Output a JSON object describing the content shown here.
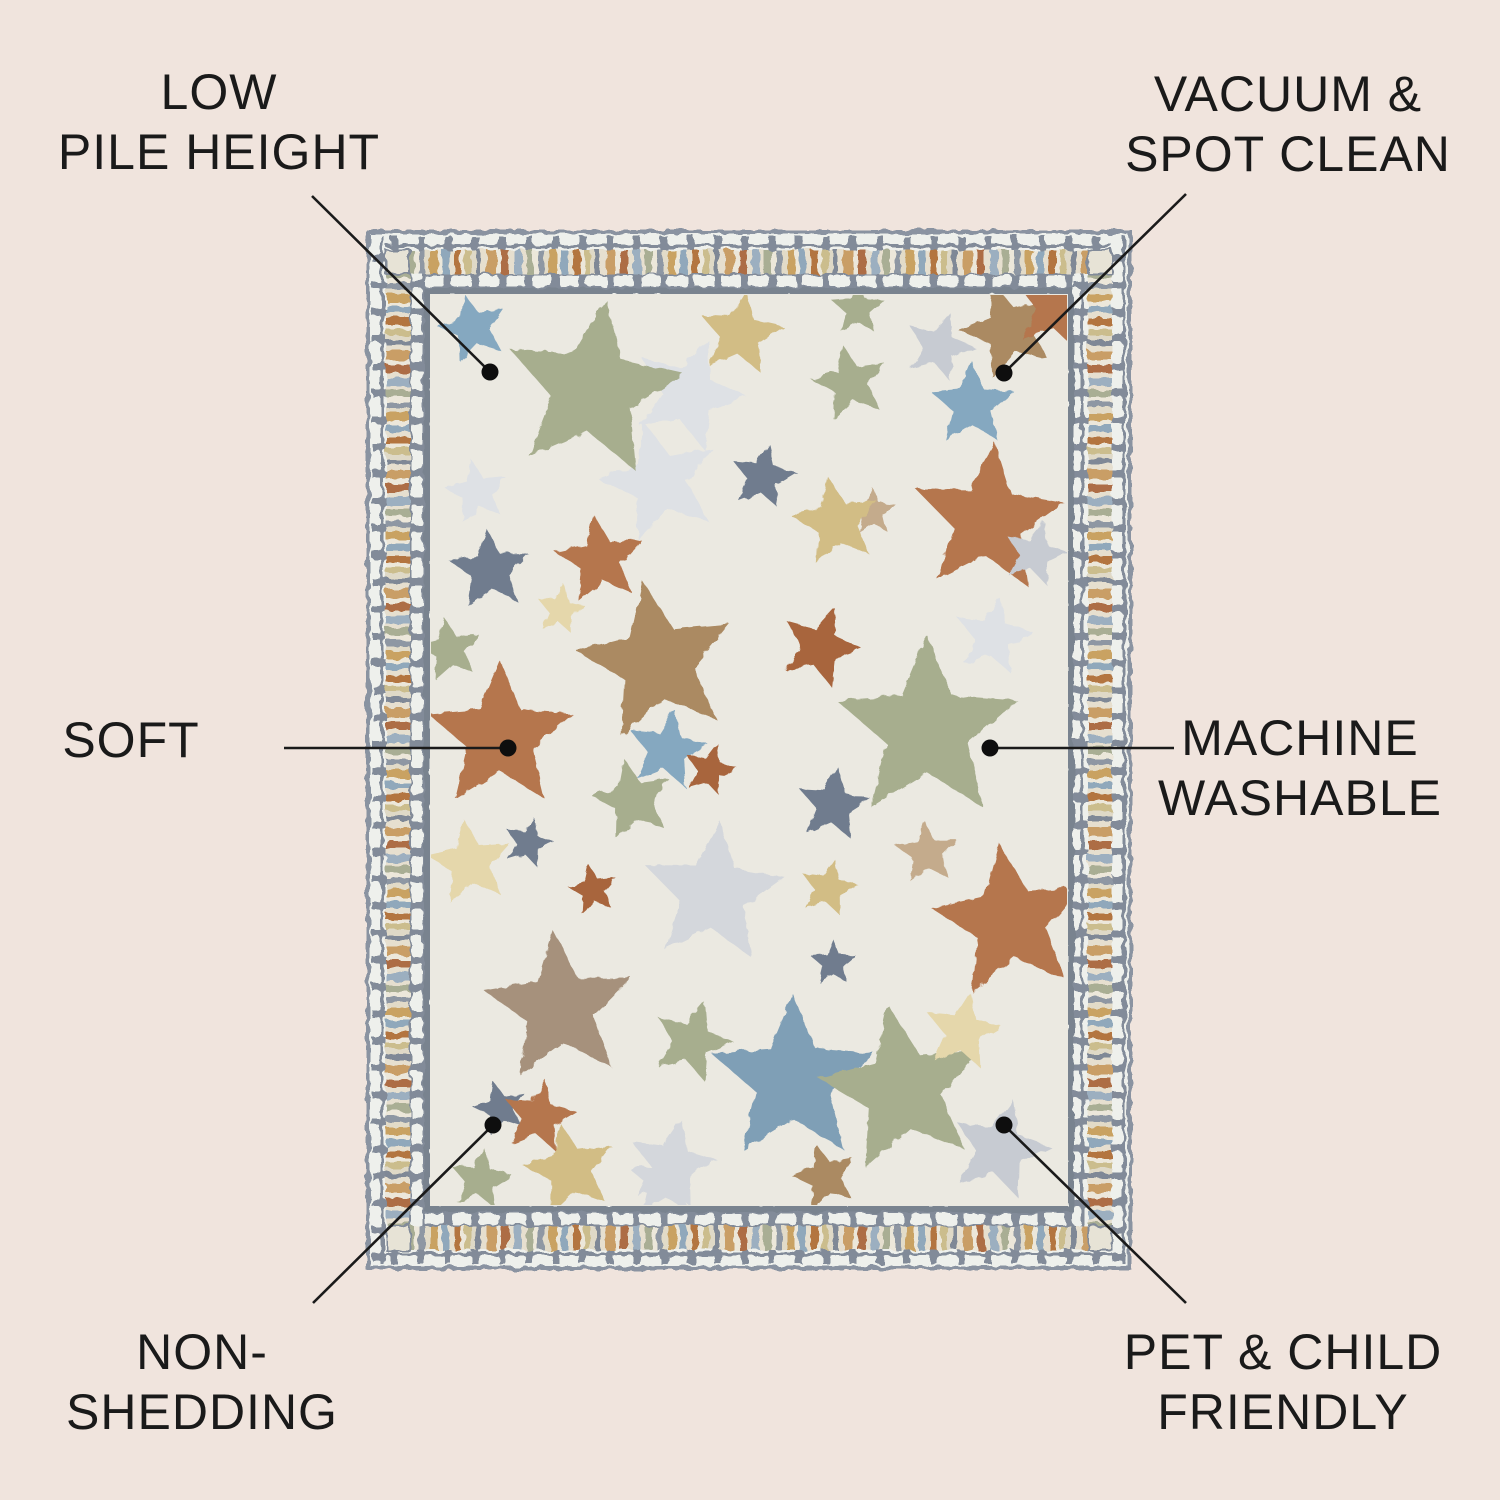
{
  "page": {
    "background": "#f0e4dd",
    "text_color": "#1a1a1a",
    "line_color": "#1a1a1a",
    "dot_color": "#0e0e0e"
  },
  "callouts": [
    {
      "id": "low-pile-height",
      "lines": [
        "LOW",
        "PILE HEIGHT"
      ],
      "dot": {
        "x": 490,
        "y": 372
      },
      "line_end": {
        "x": 312,
        "y": 196
      }
    },
    {
      "id": "vacuum-spot-clean",
      "lines": [
        "VACUUM &",
        "SPOT CLEAN"
      ],
      "dot": {
        "x": 1004,
        "y": 373
      },
      "line_end": {
        "x": 1186,
        "y": 194
      }
    },
    {
      "id": "soft",
      "lines": [
        "SOFT"
      ],
      "dot": {
        "x": 508,
        "y": 748
      },
      "line_end": {
        "x": 284,
        "y": 748
      }
    },
    {
      "id": "machine-washable",
      "lines": [
        "MACHINE",
        "WASHABLE"
      ],
      "dot": {
        "x": 990,
        "y": 748
      },
      "line_end": {
        "x": 1174,
        "y": 748
      }
    },
    {
      "id": "non-shedding",
      "lines": [
        "NON-",
        "SHEDDING"
      ],
      "dot": {
        "x": 493,
        "y": 1125
      },
      "line_end": {
        "x": 313,
        "y": 1303
      }
    },
    {
      "id": "pet-child-friendly",
      "lines": [
        "PET & CHILD",
        "FRIENDLY"
      ],
      "dot": {
        "x": 1004,
        "y": 1125
      },
      "line_end": {
        "x": 1186,
        "y": 1303
      }
    }
  ],
  "rug": {
    "field_color": "#ebe9e1",
    "border": {
      "bg": "#eef0ec",
      "mortar": "#828b99",
      "outer_line": "#8a93a1",
      "inner_line": "#79838f",
      "corner_fill": "#e7e3d6",
      "stripe_bg": "#e6e0d0",
      "stripes": [
        [
          "#c99e66",
          9
        ],
        [
          "#ece7da",
          5
        ],
        [
          "#ad6d44",
          8
        ],
        [
          "#e6dfcf",
          5
        ],
        [
          "#9cafc0",
          8
        ],
        [
          "#e6dfcf",
          4
        ],
        [
          "#a9ae94",
          7
        ],
        [
          "#ece7da",
          5
        ],
        [
          "#8e97a3",
          6
        ],
        [
          "#e2dbc8",
          5
        ],
        [
          "#c9a262",
          8
        ],
        [
          "#ece7da",
          4
        ],
        [
          "#90a8bb",
          7
        ],
        [
          "#e6dfcf",
          5
        ],
        [
          "#b3753f",
          7
        ],
        [
          "#ece7da",
          4
        ],
        [
          "#cbbd8d",
          6
        ],
        [
          "#dfd9c7",
          5
        ],
        [
          "#7f8896",
          5
        ],
        [
          "#e6dfcf",
          6
        ]
      ]
    },
    "star_colors": {
      "rust": "#b5764e",
      "rustDark": "#a8653d",
      "tan": "#ab8a62",
      "tanLight": "#c4ab8c",
      "taupe": "#a6917b",
      "sage": "#a7ae8e",
      "blue": "#85a8c0",
      "steel": "#7f9fb6",
      "slate": "#6f7c8e",
      "paleGray": "#c7cbd2",
      "silver": "#d4d7dc",
      "ghost": "#dee1e5",
      "yellow": "#d2bd85",
      "paleYellow": "#e5d7ab"
    },
    "stars": [
      [
        320,
        162,
        58,
        20,
        "ghost"
      ],
      [
        292,
        250,
        62,
        -15,
        "ghost"
      ],
      [
        109,
        260,
        33,
        -10,
        "ghost"
      ],
      [
        625,
        405,
        40,
        10,
        "ghost"
      ],
      [
        345,
        662,
        74,
        5,
        "silver"
      ],
      [
        304,
        933,
        46,
        12,
        "silver"
      ],
      [
        105,
        96,
        36,
        -15,
        "blue"
      ],
      [
        225,
        158,
        92,
        8,
        "sage"
      ],
      [
        372,
        102,
        44,
        8,
        "yellow"
      ],
      [
        482,
        151,
        40,
        -12,
        "sage"
      ],
      [
        490,
        77,
        28,
        0,
        "sage"
      ],
      [
        571,
        115,
        36,
        18,
        "paleGray"
      ],
      [
        604,
        173,
        44,
        0,
        "blue"
      ],
      [
        640,
        98,
        50,
        -18,
        "tan"
      ],
      [
        690,
        75,
        48,
        12,
        "rust"
      ],
      [
        232,
        328,
        46,
        -8,
        "rust"
      ],
      [
        395,
        245,
        34,
        10,
        "slate"
      ],
      [
        505,
        280,
        24,
        0,
        "tanLight"
      ],
      [
        468,
        290,
        46,
        -10,
        "yellow"
      ],
      [
        620,
        288,
        78,
        5,
        "rust"
      ],
      [
        667,
        322,
        34,
        15,
        "paleGray"
      ],
      [
        122,
        338,
        42,
        -5,
        "slate"
      ],
      [
        192,
        378,
        26,
        10,
        "paleYellow"
      ],
      [
        82,
        418,
        33,
        -10,
        "sage"
      ],
      [
        289,
        430,
        82,
        -10,
        "tan"
      ],
      [
        452,
        415,
        42,
        20,
        "rustDark"
      ],
      [
        559,
        498,
        95,
        0,
        "sage"
      ],
      [
        132,
        505,
        76,
        0,
        "rust"
      ],
      [
        299,
        518,
        42,
        10,
        "blue"
      ],
      [
        342,
        538,
        28,
        15,
        "rustDark"
      ],
      [
        265,
        568,
        42,
        -12,
        "sage"
      ],
      [
        465,
        573,
        38,
        8,
        "slate"
      ],
      [
        559,
        621,
        33,
        -5,
        "tanLight"
      ],
      [
        460,
        656,
        30,
        12,
        "yellow"
      ],
      [
        102,
        631,
        44,
        -8,
        "paleYellow"
      ],
      [
        160,
        611,
        26,
        15,
        "slate"
      ],
      [
        225,
        658,
        26,
        -10,
        "rustDark"
      ],
      [
        465,
        731,
        24,
        0,
        "slate"
      ],
      [
        642,
        690,
        80,
        -8,
        "rust"
      ],
      [
        192,
        776,
        78,
        -5,
        "taupe"
      ],
      [
        324,
        810,
        42,
        18,
        "sage"
      ],
      [
        132,
        876,
        28,
        -15,
        "slate"
      ],
      [
        171,
        885,
        38,
        10,
        "rust"
      ],
      [
        425,
        848,
        86,
        0,
        "steel"
      ],
      [
        535,
        858,
        86,
        -10,
        "sage"
      ],
      [
        595,
        800,
        40,
        10,
        "paleYellow"
      ],
      [
        632,
        918,
        52,
        15,
        "paleGray"
      ],
      [
        202,
        938,
        48,
        -12,
        "yellow"
      ],
      [
        112,
        948,
        32,
        8,
        "sage"
      ],
      [
        297,
        948,
        38,
        0,
        "silver"
      ],
      [
        457,
        945,
        34,
        -15,
        "tan"
      ]
    ]
  }
}
